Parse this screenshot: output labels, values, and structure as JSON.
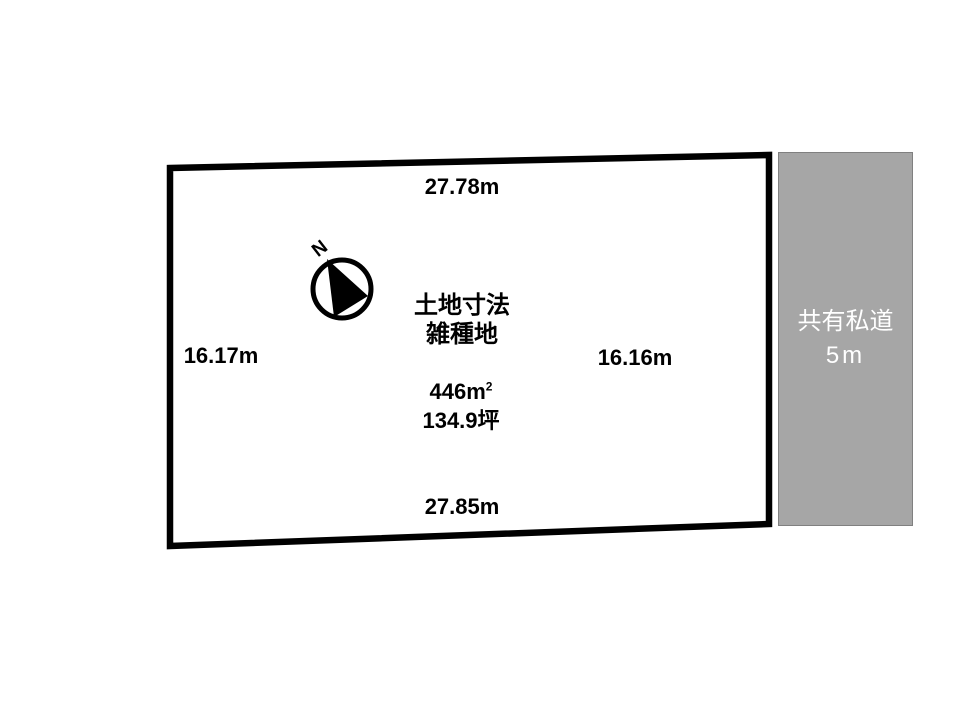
{
  "plot": {
    "center": {
      "title": "土地寸法",
      "land_type": "雑種地",
      "area_m2_base": "446m",
      "area_m2_sup": "2",
      "area_tsubo": "134.9坪"
    },
    "dimensions": {
      "top": "27.78m",
      "left": "16.17m",
      "right": "16.16m",
      "bottom": "27.85m"
    }
  },
  "compass": {
    "north_label": "N"
  },
  "road": {
    "name": "共有私道",
    "width_label": "5m"
  },
  "colors": {
    "ink": "#000000",
    "plot_fill": "#ffffff",
    "road_fill": "#a6a6a6",
    "road_border": "#808080",
    "road_text": "#ffffff",
    "background": "#ffffff"
  }
}
